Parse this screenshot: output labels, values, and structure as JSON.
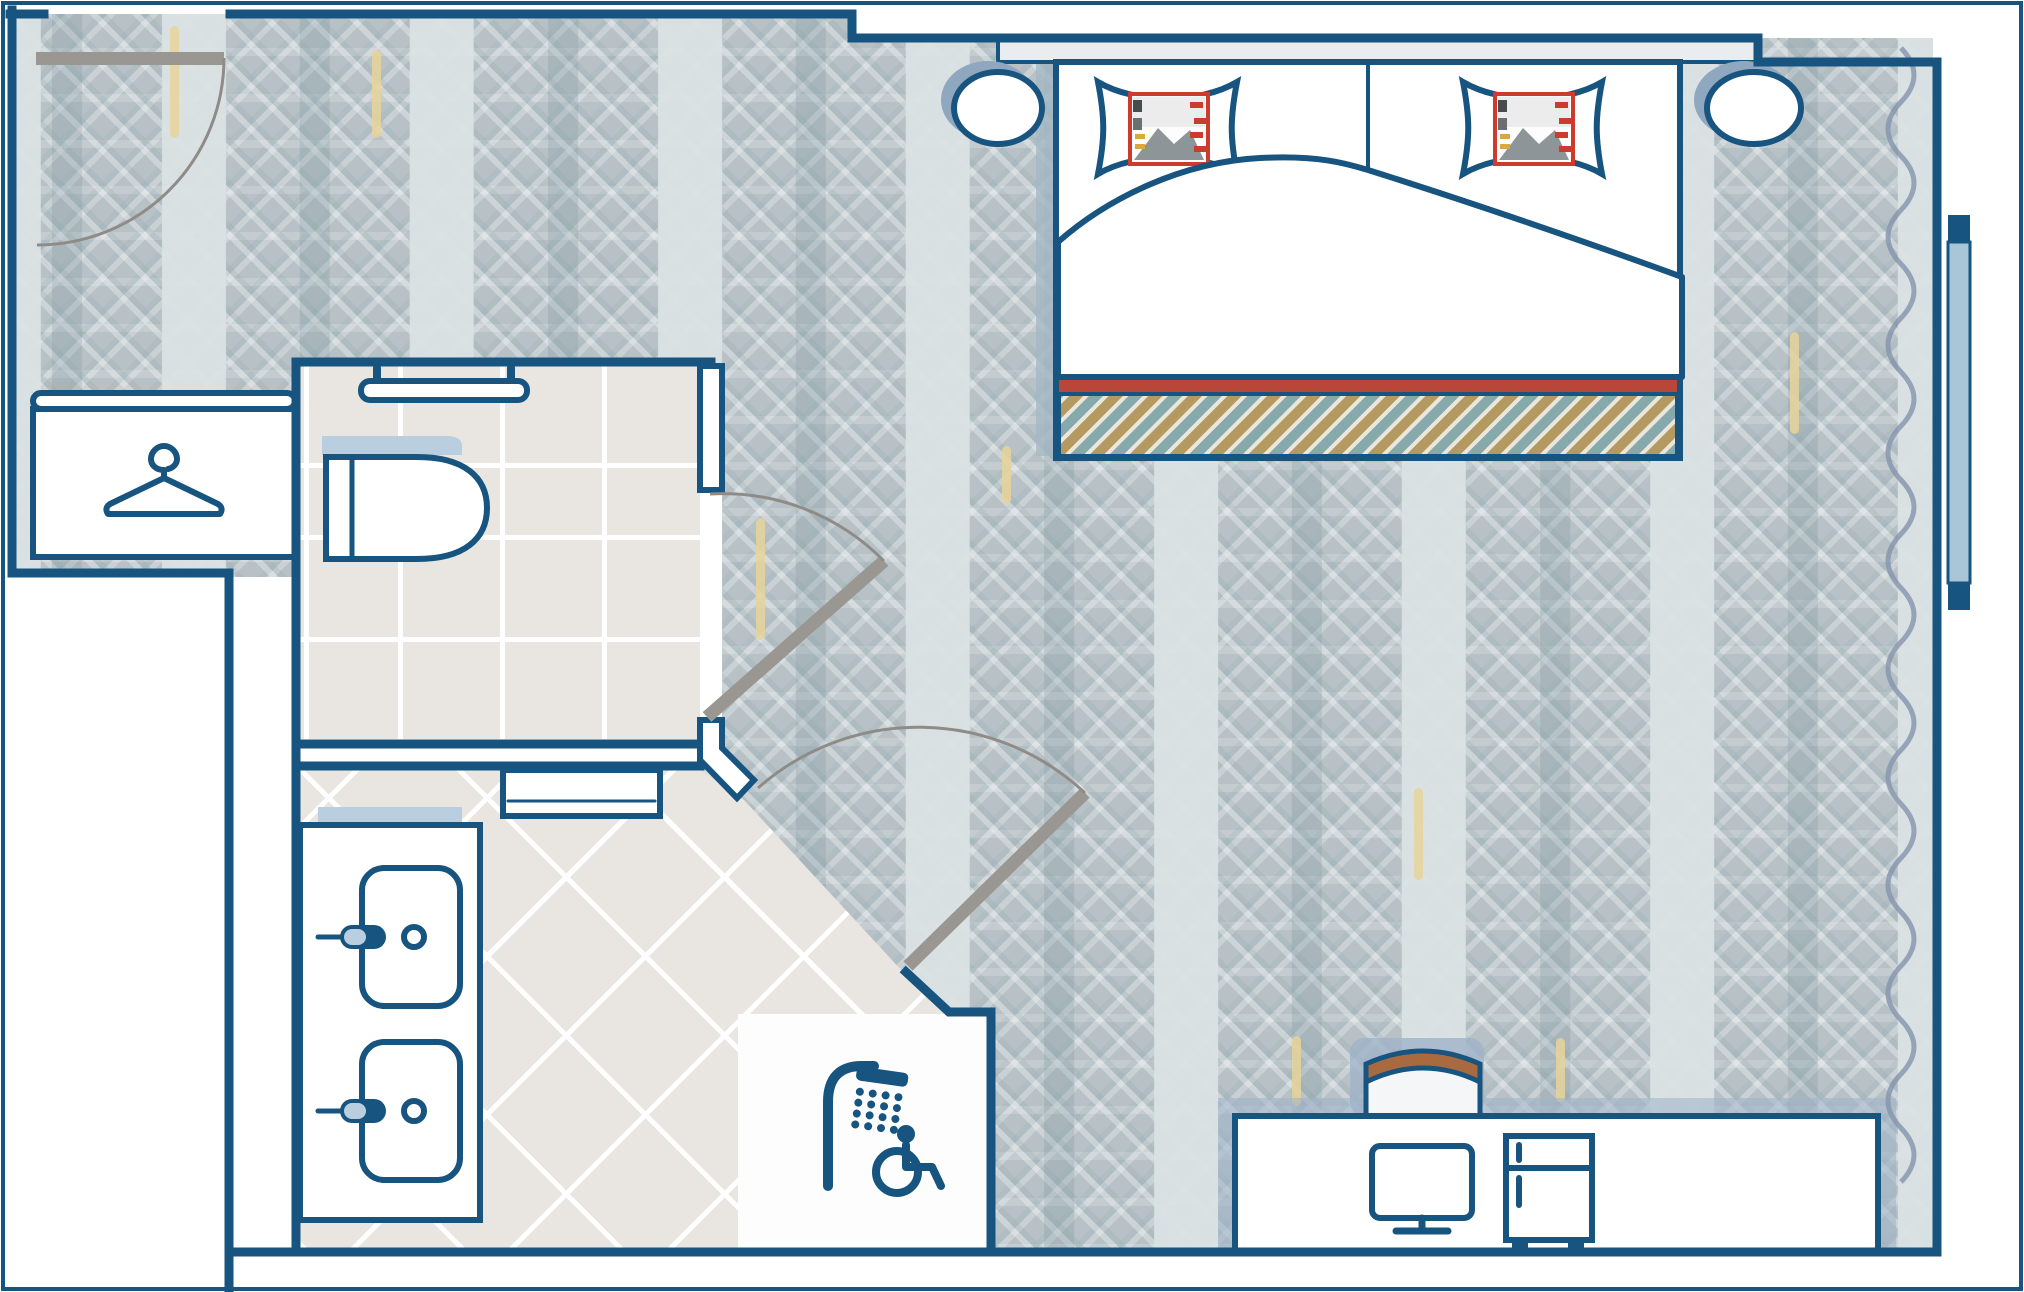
{
  "title_present": false,
  "visible_text": [],
  "colors": {
    "wall_line": "#17547f",
    "carpet_base": "#b7c1c6",
    "tile_floor": "#e9e6e1",
    "counter_light_blue": "#b9cede",
    "window_glass": "#a9c5d8",
    "door_leaf_gray": "#9a9792",
    "bed_red_band": "#b8473a",
    "pillow_print_red": "#cc3b2e",
    "blanket_tan": "#b49a60",
    "blanket_teal": "#86a9ac",
    "chair_brown": "#a96a3f",
    "shadow_blue": "#9fb3c8",
    "carpet_accent_yellow": "#e8d49a"
  },
  "icons": [
    "hanger-icon",
    "toilet-icon",
    "grab-bar-icon",
    "sink-icon",
    "faucet-icon",
    "shower-icon",
    "wheelchair-accessible-icon",
    "monitor-icon",
    "minibar-icon",
    "door-swing-icon",
    "window-icon",
    "curtain-icon"
  ],
  "inventory": {
    "double_bed": 1,
    "pillows": 2,
    "nightstands": 2,
    "wardrobe": 1,
    "toilet_room": 1,
    "toilets": 1,
    "grab_bars": 1,
    "bathroom": 1,
    "sinks": 2,
    "roll_in_shower": 1,
    "desk": 1,
    "desk_chair": 1,
    "monitor": 1,
    "minibar": 1,
    "doors_with_swing": 3,
    "windows": 1
  }
}
